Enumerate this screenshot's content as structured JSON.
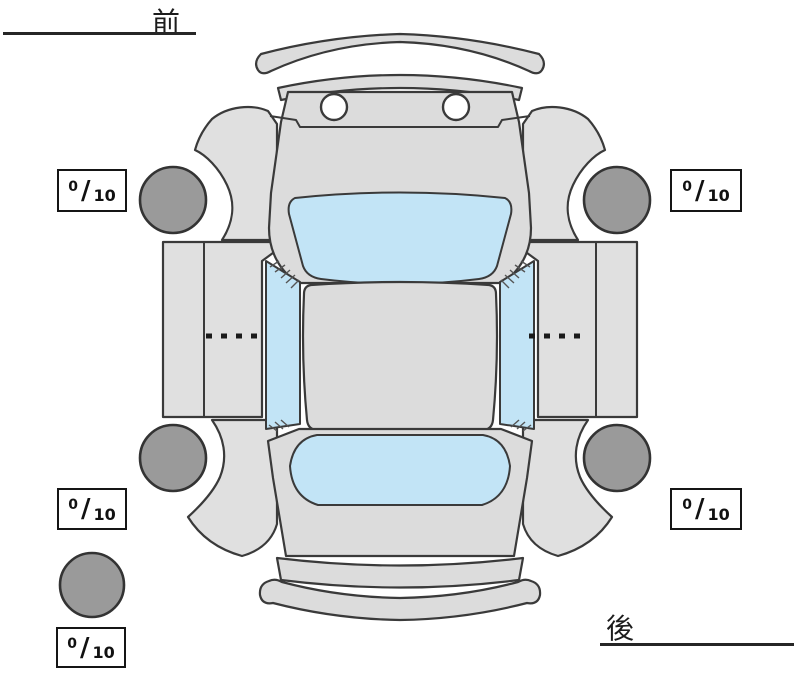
{
  "orientation": {
    "front_label": "前",
    "rear_label": "後"
  },
  "scores": {
    "separator": "/",
    "front_left": {
      "value": "0",
      "max": "10"
    },
    "front_right": {
      "value": "0",
      "max": "10"
    },
    "rear_left": {
      "value": "0",
      "max": "10"
    },
    "rear_right": {
      "value": "0",
      "max": "10"
    },
    "spare": {
      "value": "0",
      "max": "10"
    }
  },
  "colors": {
    "body": "#dcdcdc",
    "panel": "#e0e0e0",
    "glass": "#c2e4f6",
    "tire": "#9a9a9a",
    "outline": "#3a3a3a"
  }
}
